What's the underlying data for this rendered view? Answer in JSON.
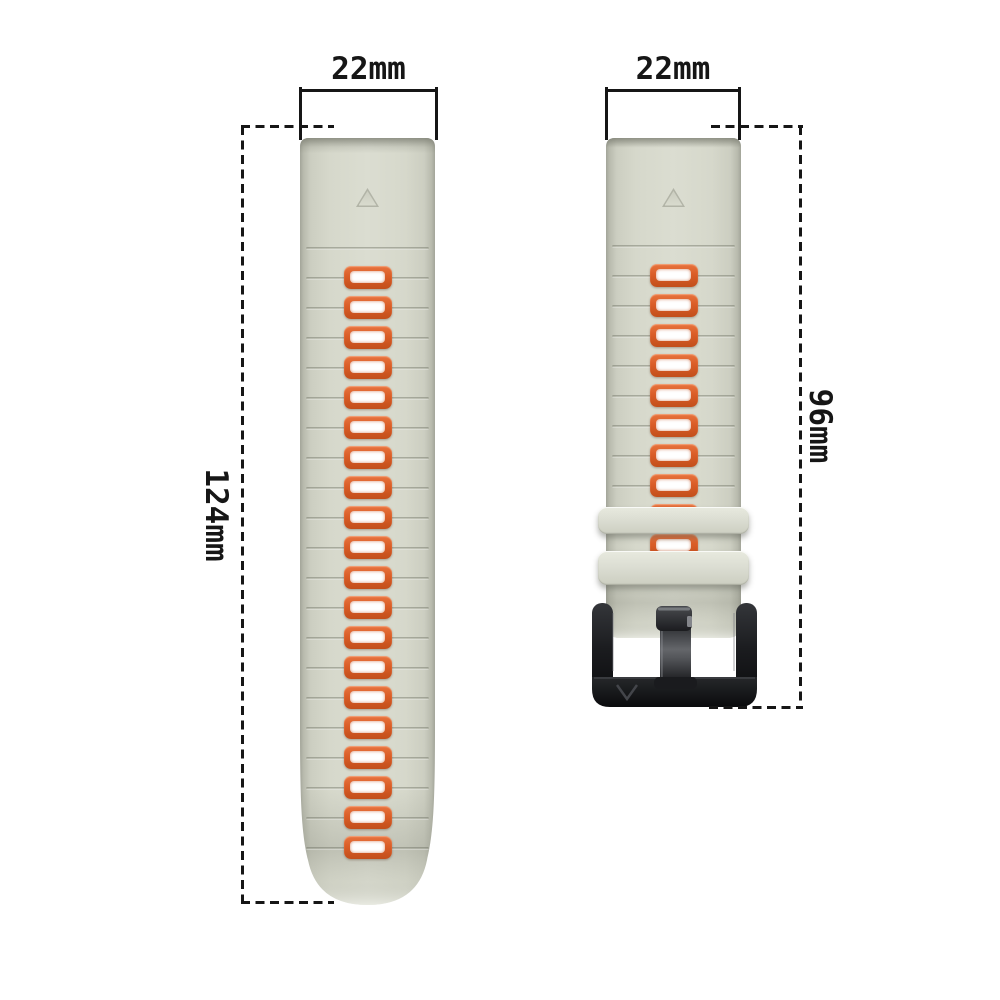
{
  "diagram": {
    "background": "#ffffff",
    "ink_color": "#161616",
    "left_band": {
      "width_label": "22mm",
      "length_label": "124mm",
      "slot_count": 20,
      "groove_count": 21,
      "has_triangle_marker": true
    },
    "right_band": {
      "width_label": "22mm",
      "length_label": "96mm",
      "slot_count": 10,
      "groove_count": 10,
      "keeper_count": 2,
      "has_buckle": true,
      "has_triangle_marker": true
    },
    "colors": {
      "band_face": "#dbddd1",
      "band_edge": "#a3a599",
      "band_chamfer": "#b7b9ac",
      "slot_frame": "#da5d27",
      "slot_hole": "#ffffff",
      "keeper_face": "#dcded3",
      "buckle_black": "#131417",
      "buckle_highlight": "#6a6c70"
    }
  }
}
